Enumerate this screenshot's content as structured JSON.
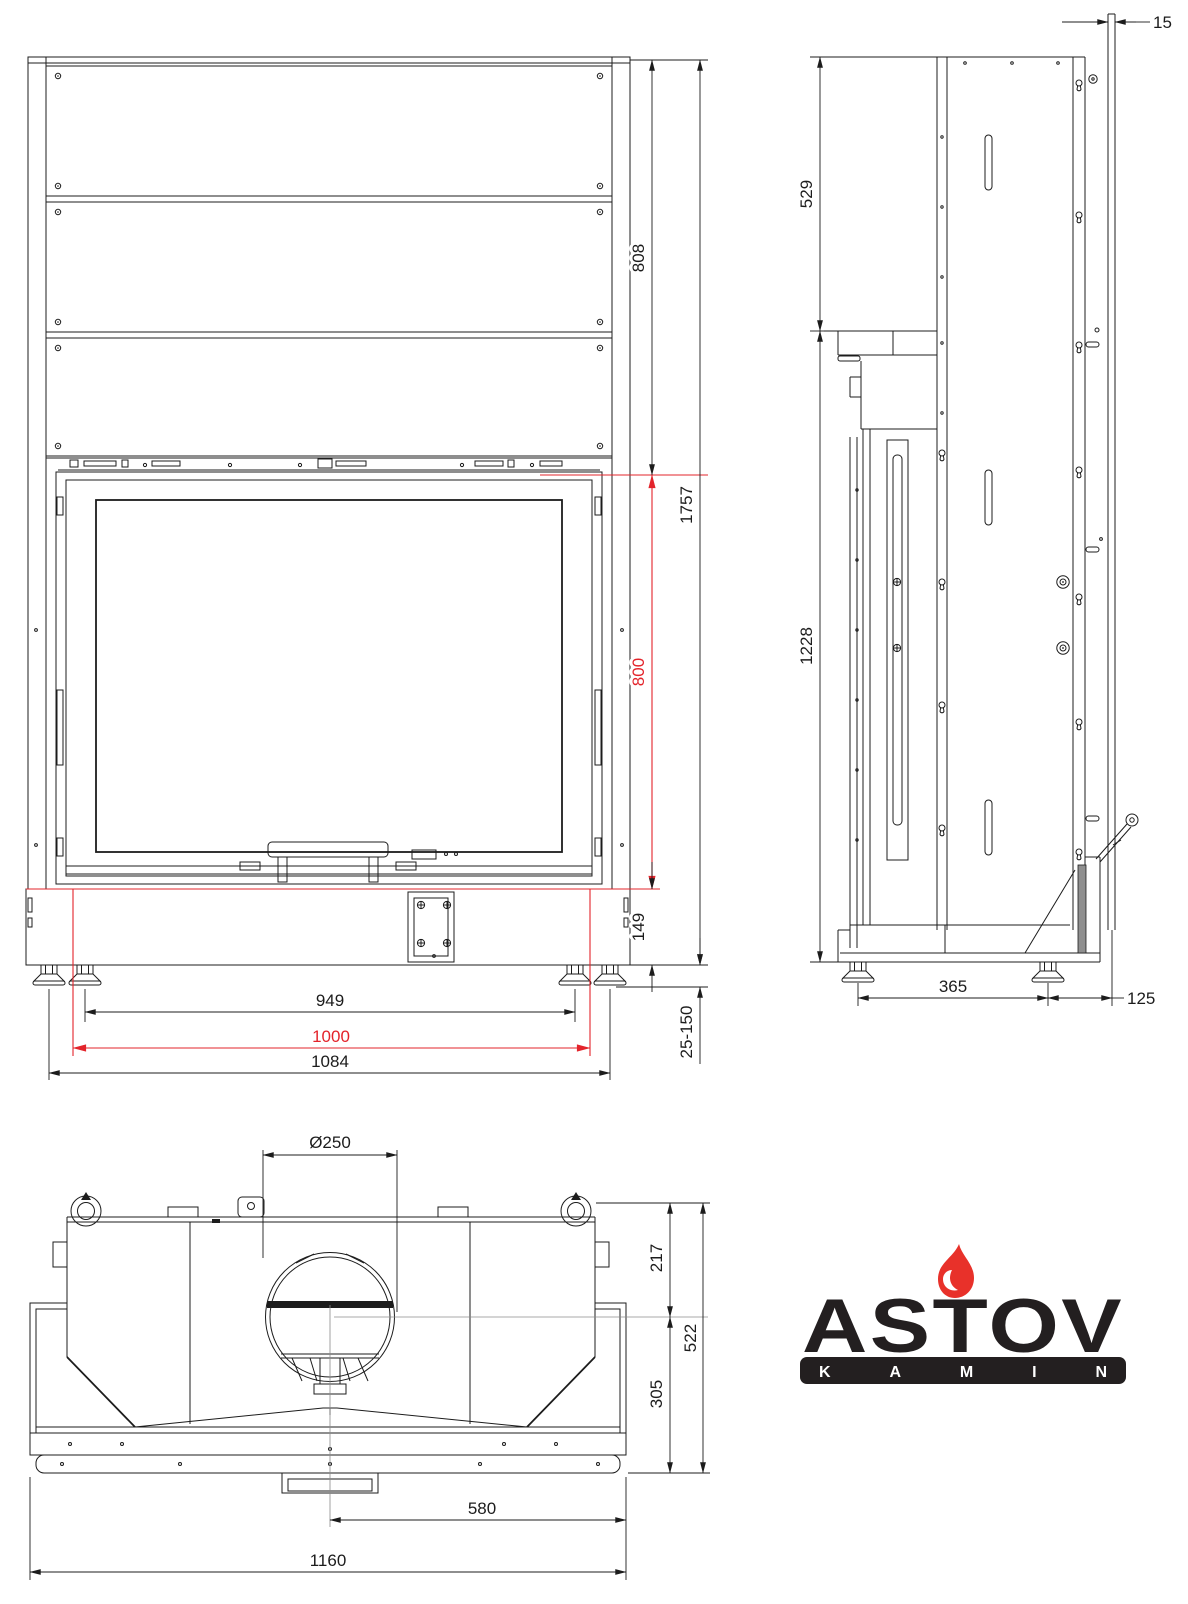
{
  "drawing": {
    "front_view": {
      "dim_upper_section_height": "808",
      "dim_total_height": "1757",
      "dim_glass_opening_height": "800",
      "dim_base_height": "149",
      "dim_leg_adjust_range": "25-150",
      "dim_legs_inner_span": "949",
      "dim_opening_width": "1000",
      "dim_legs_outer_span": "1084"
    },
    "side_view": {
      "dim_rear_panel_thickness": "15",
      "dim_upper_section_height": "529",
      "dim_lower_section_height": "1228",
      "dim_legs_span": "365",
      "dim_rear_offset": "125"
    },
    "top_view": {
      "dim_flue_diameter": "Ø250",
      "dim_rear_to_flue_center": "217",
      "dim_total_depth": "522",
      "dim_flue_center_to_front": "305",
      "dim_center_to_right_edge": "580",
      "dim_total_width": "1160"
    }
  },
  "logo": {
    "brand": "ASTOV",
    "subtitle": "KAMIN"
  },
  "colors": {
    "line": "#1c1c1c",
    "dimension_red": "#e3242b",
    "logo_black": "#231f20",
    "flame_red": "#e8312a"
  }
}
